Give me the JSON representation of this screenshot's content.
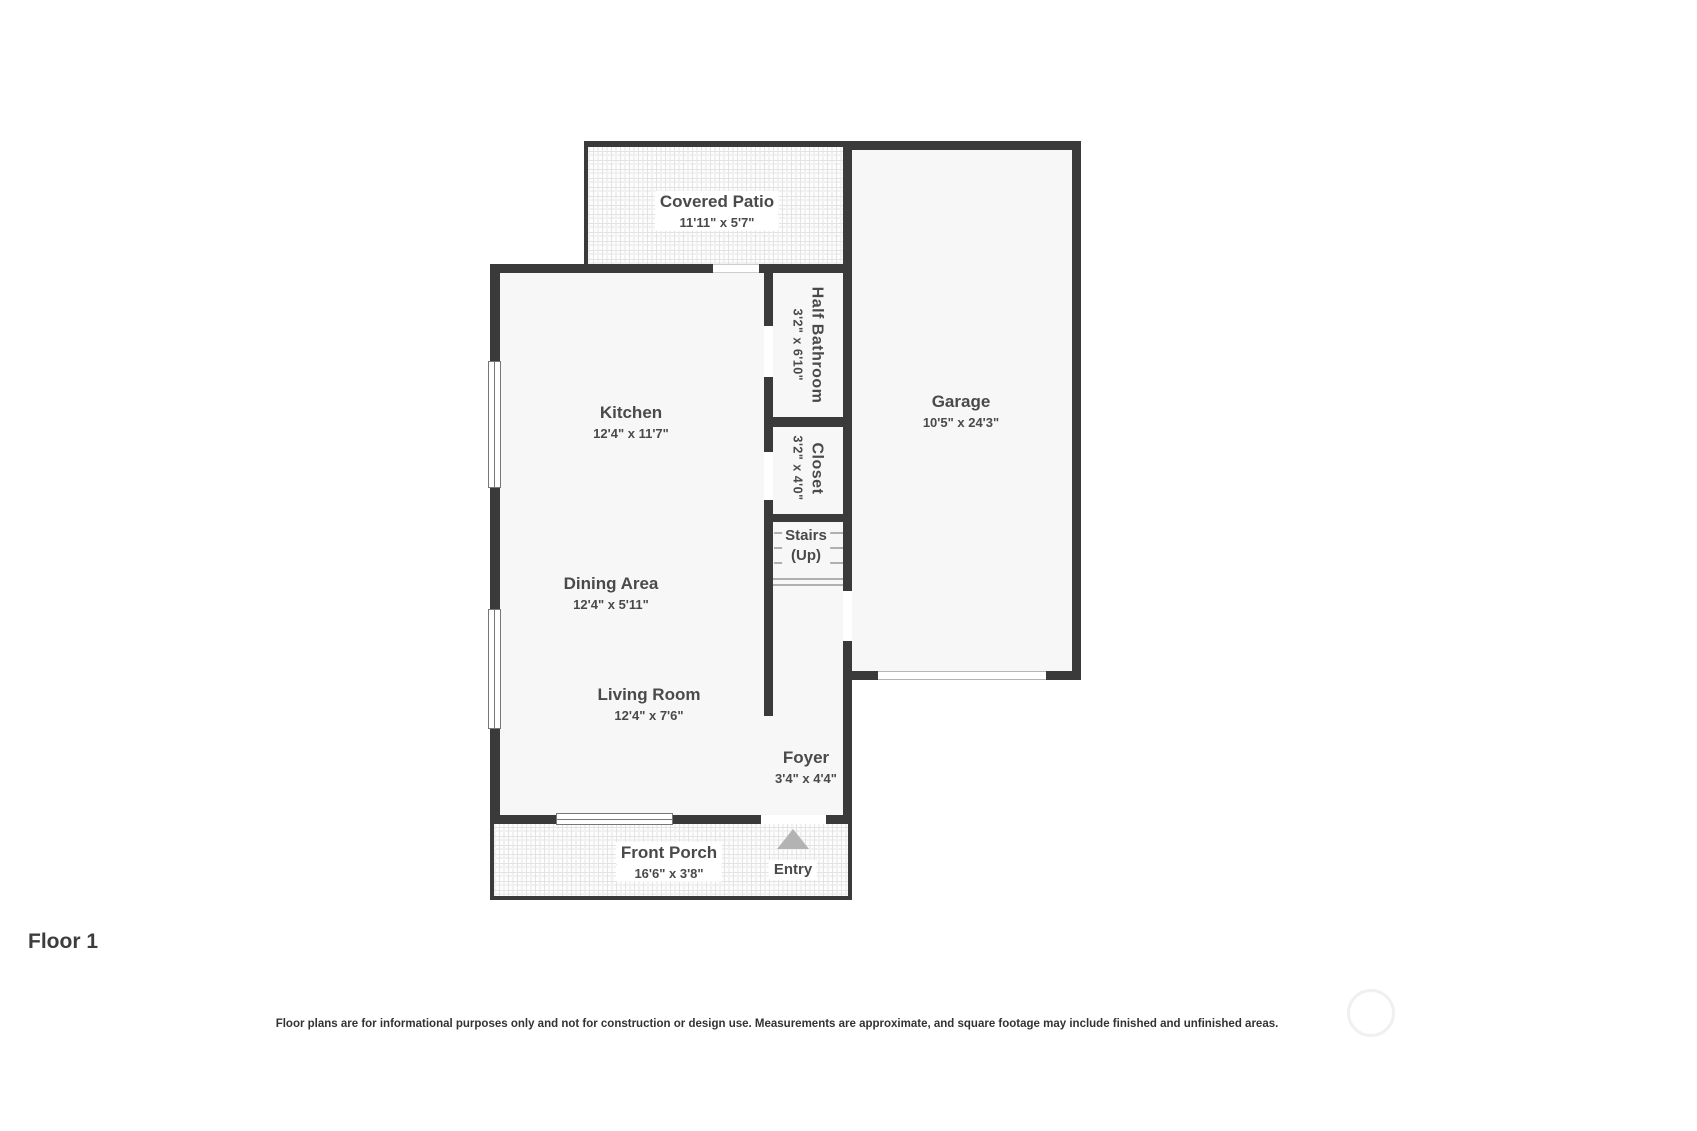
{
  "title": "Floor 1",
  "disclaimer": "Floor plans are for informational purposes only and not for construction or design use. Measurements are approximate, and square footage may include finished and unfinished areas.",
  "rooms": {
    "covered_patio": {
      "name": "Covered Patio",
      "dims": "11'11\" x 5'7\""
    },
    "kitchen": {
      "name": "Kitchen",
      "dims": "12'4\" x 11'7\""
    },
    "half_bathroom": {
      "name": "Half Bathroom",
      "dims": "3'2\" x 6'10\""
    },
    "closet": {
      "name": "Closet",
      "dims": "3'2\" x 4'0\""
    },
    "garage": {
      "name": "Garage",
      "dims": "10'5\" x 24'3\""
    },
    "stairs": {
      "name": "Stairs",
      "direction": "(Up)"
    },
    "dining_area": {
      "name": "Dining Area",
      "dims": "12'4\" x 5'11\""
    },
    "living_room": {
      "name": "Living Room",
      "dims": "12'4\" x 7'6\""
    },
    "foyer": {
      "name": "Foyer",
      "dims": "3'4\" x 4'4\""
    },
    "front_porch": {
      "name": "Front Porch",
      "dims": "16'6\" x 3'8\""
    },
    "entry": {
      "name": "Entry"
    }
  },
  "colors": {
    "wall": "#3a3a3a",
    "room_fill": "#f7f7f7",
    "label_text": "#4a4a4a",
    "entry_arrow": "#b3b3b3",
    "tile_line": "#e3e3e3",
    "window_line": "#777777",
    "stair_line": "#b0b0b0",
    "footer_text": "#333333",
    "logo_ring": "#f0f0f0"
  }
}
